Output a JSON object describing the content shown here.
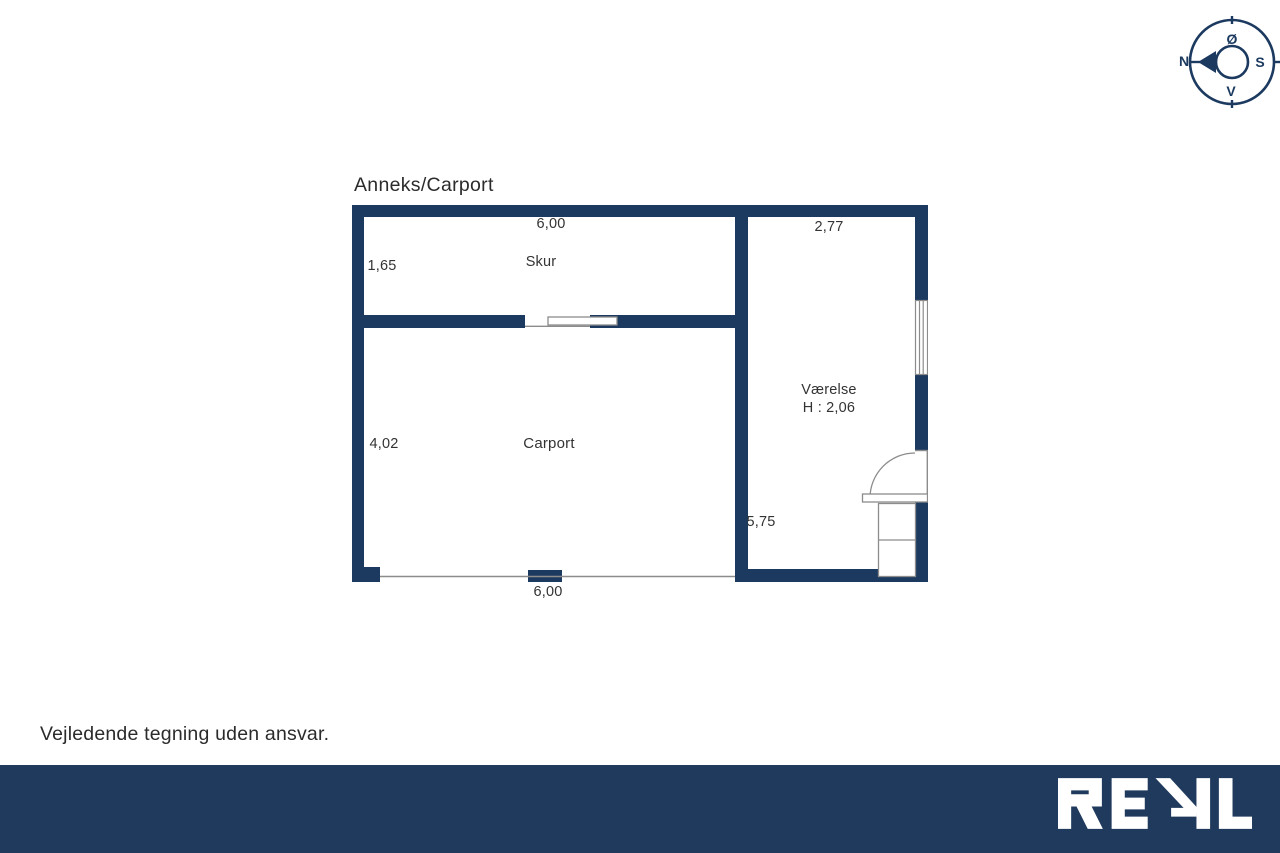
{
  "plan": {
    "title": "Anneks/Carport",
    "skur": {
      "name": "Skur",
      "width_top": "6,00",
      "depth_left": "1,65"
    },
    "carport": {
      "name": "Carport",
      "depth_left": "4,02",
      "width_bottom": "6,00"
    },
    "vaerelse": {
      "name": "Værelse",
      "ceiling_height": "H : 2,06",
      "width_top": "2,77",
      "depth_left": "5,75"
    }
  },
  "compass": {
    "north": "N",
    "east": "Ø",
    "south": "S",
    "west": "V"
  },
  "footer": {
    "disclaimer": "Vejledende tegning uden ansvar.",
    "logo_text": "REAL"
  },
  "colors": {
    "wall_navy": "#1c3a60",
    "footer_bar_navy": "#1f3a5c",
    "thin_line_gray": "#8c8c8c",
    "label_text": "#333333",
    "logo_white": "#ffffff"
  }
}
